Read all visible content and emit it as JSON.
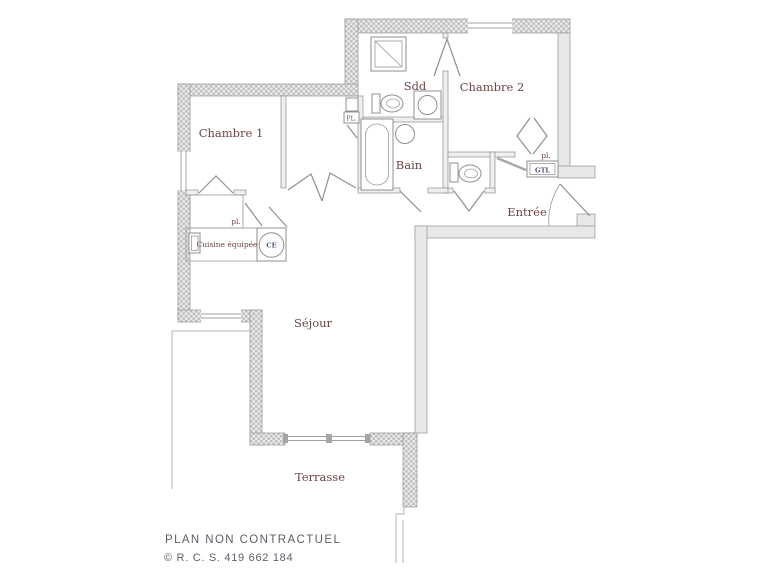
{
  "plan": {
    "rooms": {
      "chambre1": "Chambre 1",
      "chambre2": "Chambre 2",
      "sdd": "Sdd",
      "bain": "Bain",
      "entree": "Entrée",
      "sejour": "Séjour",
      "terrasse": "Terrasse",
      "cuisine": "Cuisine équipée"
    },
    "annotations": {
      "closet_chambre1": "pl.",
      "closet_entree": "pl.",
      "closet_box": "PL.",
      "gtl": "GTL",
      "water_heater": "CE"
    },
    "colors": {
      "room_label": "#6e4545",
      "equipment_label": "#4b5272",
      "wall_hatch": "#bfbfbf",
      "wall_line": "#9a9a9a",
      "footer_text": "#5b6067",
      "background": "#ffffff"
    }
  },
  "footer": {
    "disclaimer": "PLAN NON CONTRACTUEL",
    "rcs": "© R. C. S. 419 662 184"
  }
}
